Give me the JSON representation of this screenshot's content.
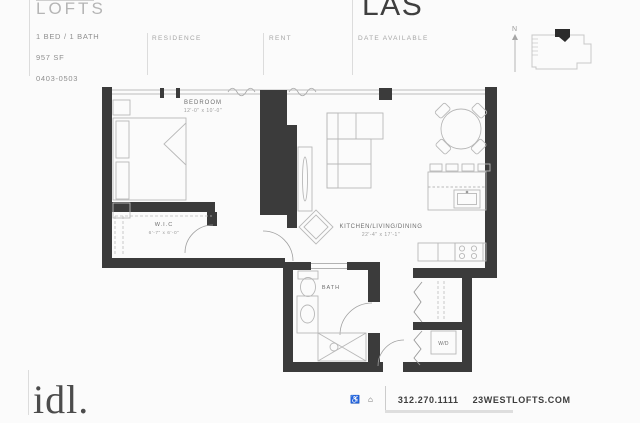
{
  "header": {
    "brand": "LOFTS",
    "plan_name": "LAS",
    "unit_type": "1 BED / 1 BATH",
    "unit_size": "957 SF",
    "unit_numbers": "0403-0503",
    "col_residence": "RESIDENCE",
    "col_rent": "RENT",
    "col_date": "DATE AVAILABLE",
    "compass_label": "N"
  },
  "floorplan": {
    "bedroom": {
      "name": "BEDROOM",
      "dims": "12'-0\" x 10'-0\""
    },
    "wic": {
      "name": "W.I.C",
      "dims": "6'-7\" x 6'-0\""
    },
    "kld": {
      "name": "KITCHEN/LIVING/DINING",
      "dims": "22'-4\" x 17'-1\""
    },
    "bath": {
      "name": "BATH"
    },
    "wd": {
      "name": "W/D"
    }
  },
  "footer": {
    "logo": "idl.",
    "phone": "312.270.1111",
    "website": "23WESTLOFTS.COM",
    "icons": {
      "accessibility": "♿",
      "equal_housing": "⌂"
    }
  },
  "colors": {
    "wall": "#3b3b3b",
    "furniture_line": "#b8b8b8",
    "accent_text": "#3f3f3f"
  }
}
